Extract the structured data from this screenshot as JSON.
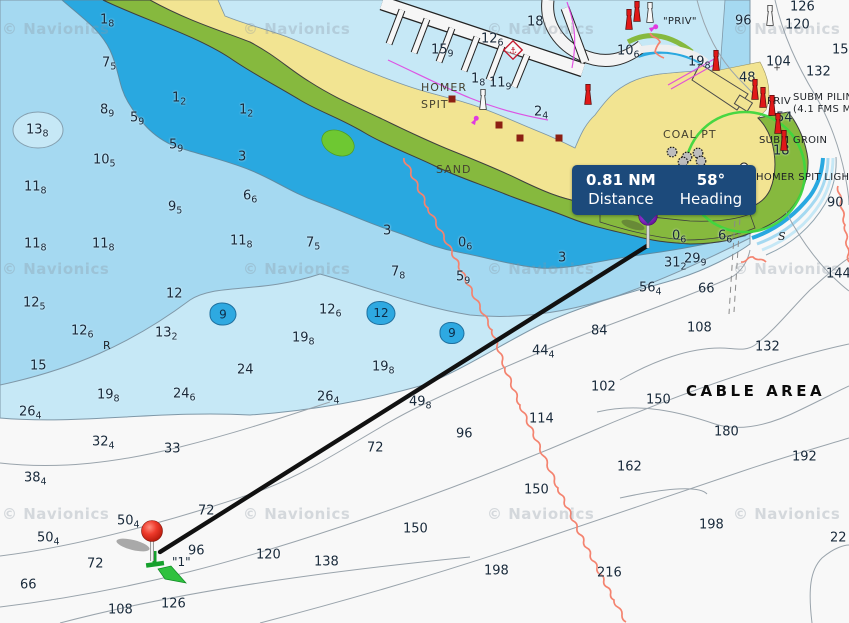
{
  "measure_tooltip": {
    "distance_value": "0.81 NM",
    "distance_label": "Distance",
    "heading_value": "58°",
    "heading_label": "Heading"
  },
  "measure": {
    "from": {
      "x": 160,
      "y": 552
    },
    "to": {
      "x": 647,
      "y": 246
    },
    "start_buoy_label": "\"1\""
  },
  "watermark": {
    "text": "© Navionics",
    "positions": [
      [
        2,
        20
      ],
      [
        243,
        20
      ],
      [
        487,
        20
      ],
      [
        733,
        20
      ],
      [
        2,
        260
      ],
      [
        243,
        260
      ],
      [
        487,
        260
      ],
      [
        733,
        260
      ],
      [
        2,
        505
      ],
      [
        243,
        505
      ],
      [
        487,
        505
      ],
      [
        733,
        505
      ]
    ]
  },
  "labels": [
    {
      "t": "HOMER",
      "x": 421,
      "y": 82,
      "c": "lbl-place"
    },
    {
      "t": "SPIT",
      "x": 421,
      "y": 99,
      "c": "lbl-place"
    },
    {
      "t": "SAND",
      "x": 436,
      "y": 164,
      "c": "lbl-place"
    },
    {
      "t": "COAL PT",
      "x": 663,
      "y": 129,
      "c": "lbl-place"
    },
    {
      "t": "CABLE AREA",
      "x": 686,
      "y": 384,
      "c": "lbl-cable"
    },
    {
      "t": "\"PRIV\"",
      "x": 663,
      "y": 17,
      "c": "lbl-small"
    },
    {
      "t": "PRIV",
      "x": 767,
      "y": 97,
      "c": "lbl-small"
    },
    {
      "t": "SUBM PILIN",
      "x": 793,
      "y": 93,
      "c": "lbl-small"
    },
    {
      "t": "(4.1 FMS M",
      "x": 793,
      "y": 105,
      "c": "lbl-small"
    },
    {
      "t": "SUBM GROIN",
      "x": 759,
      "y": 136,
      "c": "lbl-small"
    },
    {
      "t": "HOMER SPIT LIGHT",
      "x": 756,
      "y": 173,
      "c": "lbl-small"
    },
    {
      "t": "\"1\"",
      "x": 172,
      "y": 556,
      "c": "lbl-buoy"
    },
    {
      "t": "S",
      "x": 778,
      "y": 231,
      "c": "lbl-letter it"
    },
    {
      "t": "S",
      "x": 586,
      "y": 191,
      "c": "lbl-letter it"
    },
    {
      "t": "R",
      "x": 103,
      "y": 340,
      "c": "lbl-letter"
    }
  ],
  "soundings": [
    {
      "v": "1",
      "s": "8",
      "x": 100,
      "y": 21
    },
    {
      "v": "7",
      "s": "5",
      "x": 102,
      "y": 64
    },
    {
      "v": "1",
      "s": "2",
      "x": 172,
      "y": 99
    },
    {
      "v": "8",
      "s": "9",
      "x": 100,
      "y": 111
    },
    {
      "v": "5",
      "s": "9",
      "x": 130,
      "y": 119
    },
    {
      "v": "13",
      "s": "8",
      "x": 26,
      "y": 131
    },
    {
      "v": "1",
      "s": "2",
      "x": 239,
      "y": 111
    },
    {
      "v": "5",
      "s": "9",
      "x": 169,
      "y": 146
    },
    {
      "v": "10",
      "s": "5",
      "x": 93,
      "y": 161
    },
    {
      "v": "3",
      "s": "",
      "x": 238,
      "y": 157
    },
    {
      "v": "11",
      "s": "8",
      "x": 24,
      "y": 188
    },
    {
      "v": "6",
      "s": "6",
      "x": 243,
      "y": 197
    },
    {
      "v": "9",
      "s": "5",
      "x": 168,
      "y": 208
    },
    {
      "v": "11",
      "s": "8",
      "x": 24,
      "y": 245
    },
    {
      "v": "11",
      "s": "8",
      "x": 92,
      "y": 245
    },
    {
      "v": "11",
      "s": "8",
      "x": 230,
      "y": 242
    },
    {
      "v": "7",
      "s": "5",
      "x": 306,
      "y": 244
    },
    {
      "v": "3",
      "s": "",
      "x": 383,
      "y": 231
    },
    {
      "v": "0",
      "s": "6",
      "x": 458,
      "y": 244
    },
    {
      "v": "7",
      "s": "8",
      "x": 391,
      "y": 273
    },
    {
      "v": "5",
      "s": "9",
      "x": 456,
      "y": 278
    },
    {
      "v": "12",
      "s": "6",
      "x": 319,
      "y": 311
    },
    {
      "v": "19",
      "s": "8",
      "x": 292,
      "y": 339
    },
    {
      "v": "24",
      "s": "",
      "x": 237,
      "y": 370
    },
    {
      "v": "19",
      "s": "8",
      "x": 372,
      "y": 368
    },
    {
      "v": "26",
      "s": "4",
      "x": 317,
      "y": 398
    },
    {
      "v": "12",
      "s": "5",
      "x": 23,
      "y": 304
    },
    {
      "v": "12",
      "s": "6",
      "x": 71,
      "y": 332
    },
    {
      "v": "15",
      "s": "",
      "x": 30,
      "y": 366
    },
    {
      "v": "13",
      "s": "2",
      "x": 155,
      "y": 334
    },
    {
      "v": "12",
      "s": "",
      "x": 166,
      "y": 294
    },
    {
      "v": "19",
      "s": "8",
      "x": 97,
      "y": 396
    },
    {
      "v": "24",
      "s": "6",
      "x": 173,
      "y": 395
    },
    {
      "v": "26",
      "s": "4",
      "x": 19,
      "y": 413
    },
    {
      "v": "32",
      "s": "4",
      "x": 92,
      "y": 443
    },
    {
      "v": "33",
      "s": "",
      "x": 164,
      "y": 449
    },
    {
      "v": "38",
      "s": "4",
      "x": 24,
      "y": 479
    },
    {
      "v": "50",
      "s": "4",
      "x": 117,
      "y": 522
    },
    {
      "v": "50",
      "s": "4",
      "x": 37,
      "y": 539
    },
    {
      "v": "72",
      "s": "",
      "x": 87,
      "y": 564
    },
    {
      "v": "66",
      "s": "",
      "x": 20,
      "y": 585
    },
    {
      "v": "108",
      "s": "",
      "x": 108,
      "y": 610
    },
    {
      "v": "126",
      "s": "",
      "x": 161,
      "y": 604
    },
    {
      "v": "96",
      "s": "",
      "x": 188,
      "y": 551
    },
    {
      "v": "72",
      "s": "",
      "x": 198,
      "y": 511
    },
    {
      "v": "120",
      "s": "",
      "x": 256,
      "y": 555
    },
    {
      "v": "138",
      "s": "",
      "x": 314,
      "y": 562
    },
    {
      "v": "49",
      "s": "8",
      "x": 409,
      "y": 403
    },
    {
      "v": "72",
      "s": "",
      "x": 367,
      "y": 448
    },
    {
      "v": "96",
      "s": "",
      "x": 456,
      "y": 434
    },
    {
      "v": "114",
      "s": "",
      "x": 529,
      "y": 419
    },
    {
      "v": "102",
      "s": "",
      "x": 591,
      "y": 387
    },
    {
      "v": "150",
      "s": "",
      "x": 524,
      "y": 490
    },
    {
      "v": "150",
      "s": "",
      "x": 403,
      "y": 529
    },
    {
      "v": "162",
      "s": "",
      "x": 617,
      "y": 467
    },
    {
      "v": "198",
      "s": "",
      "x": 484,
      "y": 571
    },
    {
      "v": "216",
      "s": "",
      "x": 597,
      "y": 573
    },
    {
      "v": "56",
      "s": "4",
      "x": 639,
      "y": 289
    },
    {
      "v": "66",
      "s": "",
      "x": 698,
      "y": 289
    },
    {
      "v": "84",
      "s": "",
      "x": 591,
      "y": 331
    },
    {
      "v": "44",
      "s": "4",
      "x": 532,
      "y": 352
    },
    {
      "v": "108",
      "s": "",
      "x": 687,
      "y": 328
    },
    {
      "v": "132",
      "s": "",
      "x": 755,
      "y": 347
    },
    {
      "v": "150",
      "s": "",
      "x": 646,
      "y": 400
    },
    {
      "v": "180",
      "s": "",
      "x": 714,
      "y": 432
    },
    {
      "v": "192",
      "s": "",
      "x": 792,
      "y": 457
    },
    {
      "v": "198",
      "s": "",
      "x": 699,
      "y": 525
    },
    {
      "v": "22",
      "s": "",
      "x": 830,
      "y": 538
    },
    {
      "v": "90",
      "s": "",
      "x": 827,
      "y": 203
    },
    {
      "v": "144",
      "s": "",
      "x": 826,
      "y": 274
    },
    {
      "v": "0",
      "s": "6",
      "x": 672,
      "y": 237
    },
    {
      "v": "6",
      "s": "6",
      "x": 718,
      "y": 237
    },
    {
      "v": "31",
      "s": "2",
      "x": 664,
      "y": 264
    },
    {
      "v": "29",
      "s": "9",
      "x": 684,
      "y": 260
    },
    {
      "v": "3",
      "s": "",
      "x": 558,
      "y": 258
    },
    {
      "v": "96",
      "s": "",
      "x": 735,
      "y": 21
    },
    {
      "v": "126",
      "s": "",
      "x": 790,
      "y": 7
    },
    {
      "v": "120",
      "s": "",
      "x": 785,
      "y": 25
    },
    {
      "v": "150",
      "s": "",
      "x": 832,
      "y": 50
    },
    {
      "v": "104",
      "s": "",
      "x": 766,
      "y": 62
    },
    {
      "v": "132",
      "s": "",
      "x": 806,
      "y": 72
    },
    {
      "v": "48",
      "s": "",
      "x": 739,
      "y": 78
    },
    {
      "v": "19",
      "s": "8",
      "x": 688,
      "y": 63
    },
    {
      "v": "54",
      "s": "",
      "x": 776,
      "y": 118
    },
    {
      "v": "18",
      "s": "",
      "x": 527,
      "y": 22
    },
    {
      "v": "12",
      "s": "6",
      "x": 481,
      "y": 40
    },
    {
      "v": "15",
      "s": "9",
      "x": 431,
      "y": 51
    },
    {
      "v": "11",
      "s": "9",
      "x": 489,
      "y": 84
    },
    {
      "v": "1",
      "s": "8",
      "x": 471,
      "y": 80
    },
    {
      "v": "2",
      "s": "4",
      "x": 534,
      "y": 113
    },
    {
      "v": "10",
      "s": "6",
      "x": 617,
      "y": 52
    },
    {
      "v": "18",
      "s": "",
      "x": 773,
      "y": 151
    }
  ],
  "depth_blobs": [
    {
      "label": "9",
      "x": 223,
      "y": 314,
      "w": 25,
      "h": 21
    },
    {
      "label": "12",
      "x": 381,
      "y": 313,
      "w": 27,
      "h": 22
    },
    {
      "label": "9",
      "x": 452,
      "y": 333,
      "w": 23,
      "h": 20
    }
  ],
  "icons": [
    {
      "type": "red-beacon",
      "x": 629,
      "y": 20
    },
    {
      "type": "red-beacon",
      "x": 637,
      "y": 12
    },
    {
      "type": "red-beacon",
      "x": 716,
      "y": 61
    },
    {
      "type": "red-beacon",
      "x": 755,
      "y": 90
    },
    {
      "type": "red-beacon",
      "x": 763,
      "y": 98
    },
    {
      "type": "red-beacon",
      "x": 772,
      "y": 106
    },
    {
      "type": "red-beacon",
      "x": 778,
      "y": 124
    },
    {
      "type": "red-beacon",
      "x": 784,
      "y": 141
    },
    {
      "type": "red-beacon",
      "x": 588,
      "y": 95
    },
    {
      "type": "white-beacon",
      "x": 650,
      "y": 13
    },
    {
      "type": "white-beacon",
      "x": 770,
      "y": 16
    },
    {
      "type": "white-beacon",
      "x": 483,
      "y": 100
    },
    {
      "type": "light-flare",
      "x": 657,
      "y": 26,
      "angle": 150
    },
    {
      "type": "light-flare",
      "x": 477,
      "y": 117,
      "angle": 120
    },
    {
      "type": "tank",
      "x": 672,
      "y": 152
    },
    {
      "type": "tank",
      "x": 687,
      "y": 157
    },
    {
      "type": "tank",
      "x": 698,
      "y": 153
    },
    {
      "type": "tank",
      "x": 683,
      "y": 162
    },
    {
      "type": "tank",
      "x": 701,
      "y": 161
    },
    {
      "type": "building",
      "x": 455,
      "y": 102
    },
    {
      "type": "building",
      "x": 502,
      "y": 128
    },
    {
      "type": "building",
      "x": 523,
      "y": 141
    },
    {
      "type": "building",
      "x": 562,
      "y": 141
    },
    {
      "type": "bell-buoy",
      "x": 744,
      "y": 171
    },
    {
      "type": "anchorage",
      "x": 513,
      "y": 50
    },
    {
      "type": "cross",
      "x": 777,
      "y": 69
    }
  ],
  "cables": [
    {
      "points": [
        [
          404,
          158
        ],
        [
          428,
          208
        ],
        [
          452,
          252
        ],
        [
          472,
          292
        ],
        [
          492,
          330
        ],
        [
          505,
          368
        ],
        [
          520,
          405
        ],
        [
          540,
          448
        ],
        [
          558,
          488
        ],
        [
          577,
          528
        ],
        [
          597,
          568
        ],
        [
          614,
          600
        ],
        [
          626,
          622
        ]
      ],
      "amp": 2.8
    },
    {
      "points": [
        [
          838,
          186
        ],
        [
          845,
          225
        ],
        [
          849,
          262
        ]
      ],
      "amp": 2.2
    },
    {
      "points": [
        [
          741,
          262
        ],
        [
          753,
          257
        ],
        [
          766,
          262
        ]
      ],
      "amp": 1.8
    },
    {
      "points": [
        [
          650,
          33
        ],
        [
          660,
          42
        ],
        [
          655,
          52
        ],
        [
          664,
          58
        ]
      ],
      "amp": 1.5
    }
  ],
  "colors": {
    "water_shallow": "#29a8e0",
    "water_mid": "#a5d9f1",
    "water_light": "#c6e8f6",
    "water_deep": "#f8f8f8",
    "land": "#f2e492",
    "shore_green": "#86b93e",
    "route_line": "#111111",
    "cable": "#f4836f",
    "tooltip_bg": "#1c4a7b",
    "pin_start": "#e8382b",
    "pin_end": "#8d2fd0",
    "buoy_green": "#22a93c",
    "ring_green": "#3ed63e",
    "magenta": "#e03ae0",
    "blob_blue": "#2ea9e1"
  }
}
